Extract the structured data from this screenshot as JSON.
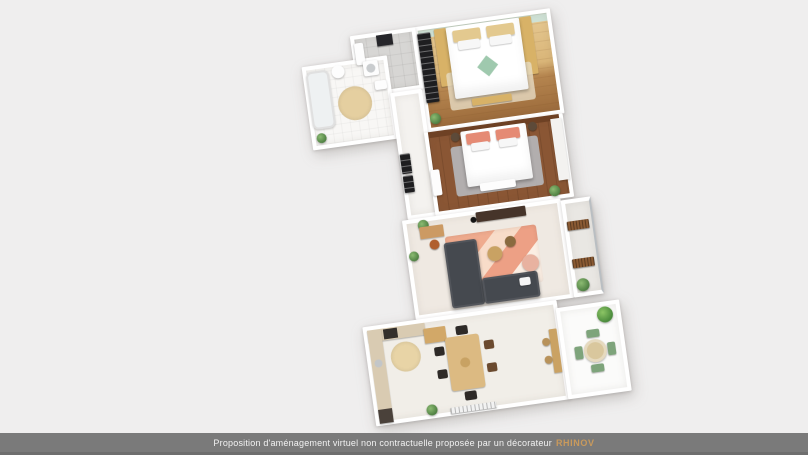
{
  "footer": {
    "disclaimer": "Proposition d'aménagement virtuel non contractuelle proposée par un décorateur",
    "brand": "RHINOV"
  },
  "palette": {
    "background": "#efeeee",
    "footer_bar": "#7a7a7a",
    "footer_text": "#f2f2f2",
    "brand_gold": "#c99a5c",
    "wall_white": "#ffffff",
    "wood_light": "#d8b267",
    "wood_floor_dark": "#8a5634",
    "entry_tile_gray": "#d7d6d4",
    "sofa_gray": "#45494f",
    "rug_salmon": "#efab8e",
    "headboard_mint": "#cfe2d6",
    "pillow_coral": "#e58a74",
    "bed_diamond_green": "#9fc9ae",
    "rug_beige": "#e8d4a6",
    "plant_green": "#6fa35f",
    "terrace_chair_green": "#7ea47b"
  },
  "floorplan": {
    "type": "3d-apartment-top-view",
    "rooms": [
      "bedroom-1",
      "entry-hall",
      "bathroom",
      "hallway",
      "bedroom-2",
      "living-room",
      "balcony",
      "kitchen-dining",
      "terrace"
    ]
  }
}
